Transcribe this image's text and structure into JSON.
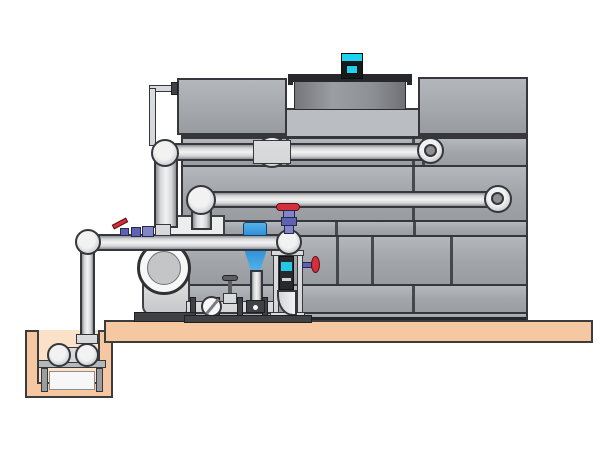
{
  "title": "Cooling tower installation — side elevation diagram",
  "scene": {
    "background": "#ffffff",
    "description": "Technical illustration of a packaged crossflow cooling tower with paneled casing, rooftop fan shroud and motor, hot/cold water piping, base-mounted centrifugal pump with valve skid, pipe support stand, and a below-grade sump pit pump on a concrete slab.",
    "visible_text": []
  },
  "colors": {
    "bg": "#ffffff",
    "line": "#35373c",
    "tower": "#a3a6ab",
    "towerLight": "#b4b7bc",
    "towerDark": "#989ba0",
    "recess": "#babdc2",
    "rim": "#26282c",
    "shroudDark": "#74767b",
    "shroudLight": "#9b9ea3",
    "motorCyan": "#1dd2ee",
    "motorDark": "#17191c",
    "pipeLight": "#f2f2f3",
    "pipeMid": "#d5d6d8",
    "pipeDark": "#8e8f93",
    "slab": "#f6c8a2",
    "pitInner": "#fbe1c7",
    "groundLine": "#3c3c3c",
    "steel": "#dcdde0",
    "steelDark": "#3f4145",
    "equip": "#eceded",
    "red": "#d4303c",
    "purple": "#5e62b0",
    "purpleLight": "#8286c8",
    "blue": "#2f8fd8",
    "blueLight": "#55b4e8",
    "cyan": "#25c8e4",
    "darkBox": "#26282b",
    "white": "#f7f7f8"
  },
  "components": [
    {
      "name": "cooling-tower-casing",
      "kind": "vessel"
    },
    {
      "name": "fan-shroud",
      "kind": "mechanical"
    },
    {
      "name": "fan-motor",
      "kind": "motor",
      "color": "cyan"
    },
    {
      "name": "hot-water-return-pipe",
      "kind": "pipe",
      "route": "vertical riser to upper tower inlet"
    },
    {
      "name": "equalizer-pipe",
      "kind": "pipe",
      "route": "mid-level line into tower"
    },
    {
      "name": "suction-header-pipe",
      "kind": "pipe",
      "route": "low horizontal header to sump riser"
    },
    {
      "name": "centrifugal-pump",
      "kind": "pump"
    },
    {
      "name": "valve-skid",
      "kind": "piping",
      "items": [
        "butterfly-valve",
        "globe-valve",
        "flanged-spools"
      ]
    },
    {
      "name": "actuated-valve",
      "kind": "valve",
      "color": "blue"
    },
    {
      "name": "gate-valve",
      "kind": "valve",
      "color": "red-handwheel"
    },
    {
      "name": "ball-valve",
      "kind": "valve",
      "color": "red-lever"
    },
    {
      "name": "pipe-support-stand",
      "kind": "structure",
      "detail": "control box with cyan display, drain valve, bottom elbow"
    },
    {
      "name": "concrete-slab",
      "kind": "civil",
      "color": "peach"
    },
    {
      "name": "sump-pit",
      "kind": "civil"
    },
    {
      "name": "sump-pump",
      "kind": "pump",
      "detail": "horizontal pump on stand inside pit"
    }
  ]
}
